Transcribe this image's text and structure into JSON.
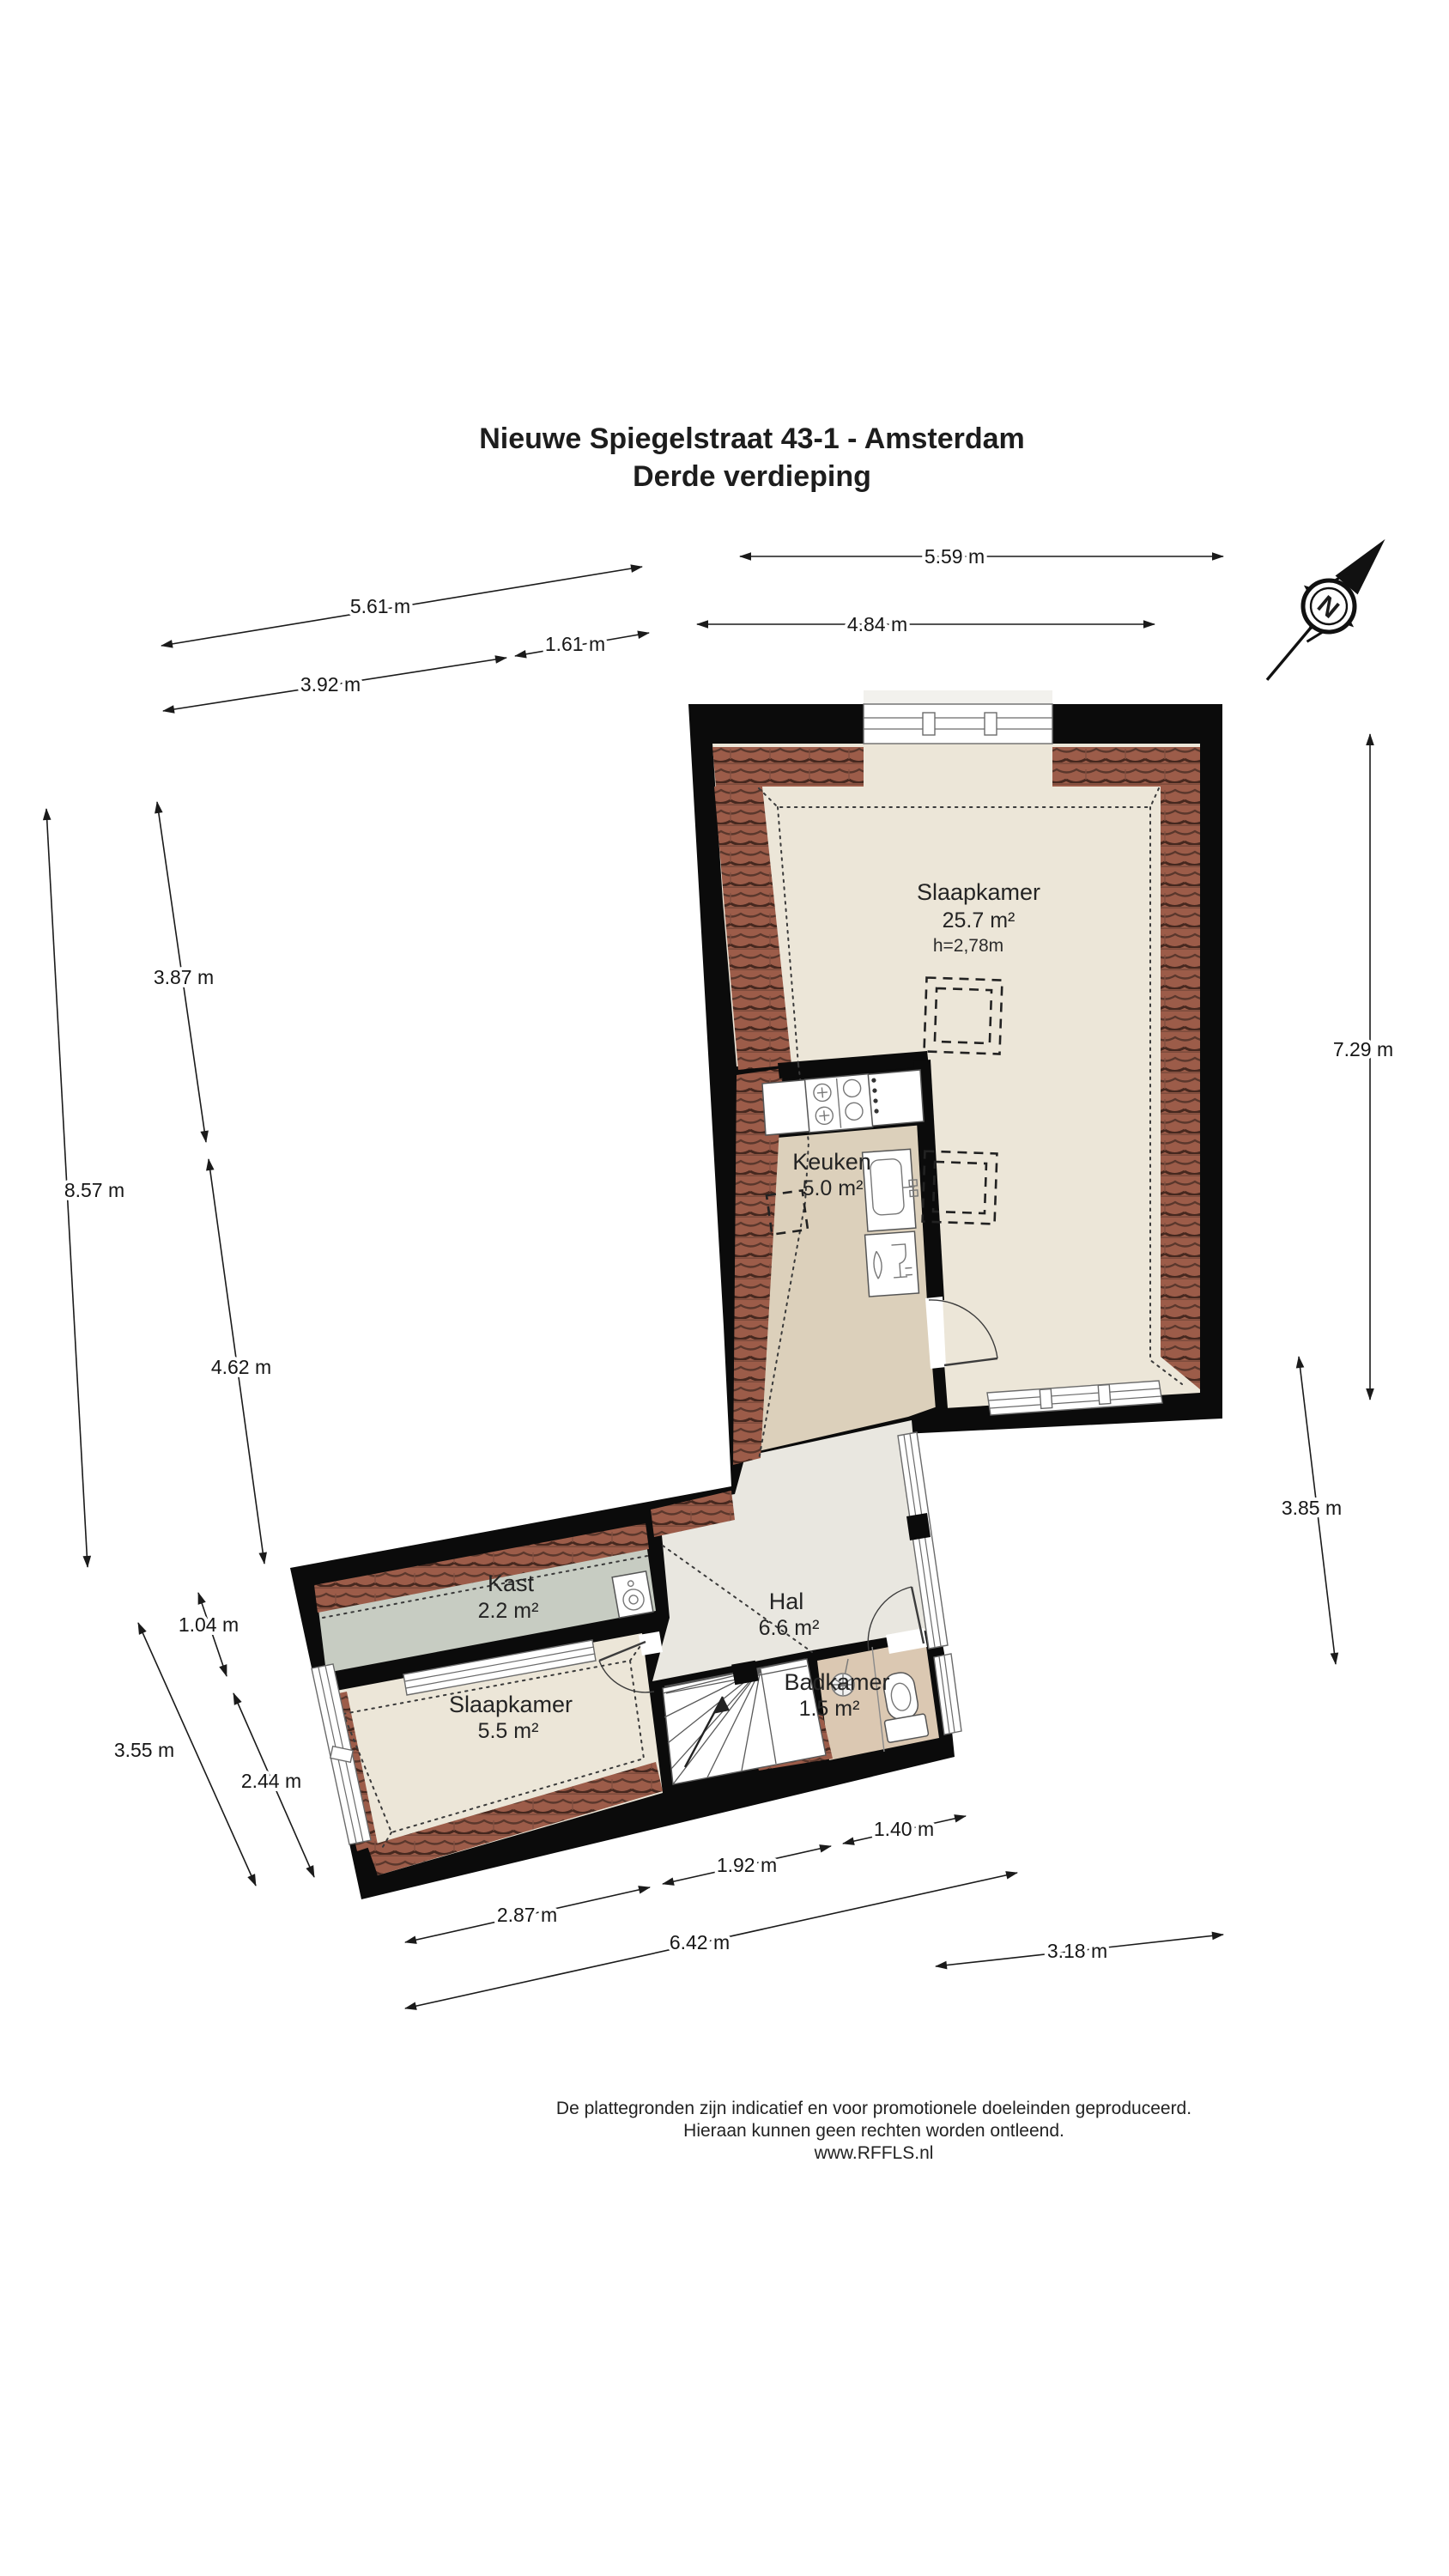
{
  "title": {
    "line1": "Nieuwe Spiegelstraat 43-1 - Amsterdam",
    "line2": "Derde verdieping"
  },
  "rooms": {
    "slaapkamer1": {
      "name": "Slaapkamer",
      "area": "25.7 m²",
      "ceiling": "h=2,78m"
    },
    "keuken": {
      "name": "Keuken",
      "area": "5.0 m²"
    },
    "kast": {
      "name": "Kast",
      "area": "2.2 m²"
    },
    "hal": {
      "name": "Hal",
      "area": "6.6 m²"
    },
    "slaapkamer2": {
      "name": "Slaapkamer",
      "area": "5.5 m²"
    },
    "badkamer": {
      "name": "Badkamer",
      "area": "1.5 m²"
    }
  },
  "dimensions": {
    "top_559": "5.59 m",
    "top_484": "4.84 m",
    "top_561": "5.61 m",
    "top_161": "1.61 m",
    "top_392": "3.92 m",
    "left_387": "3.87 m",
    "left_857": "8.57 m",
    "left_462": "4.62 m",
    "left_104": "1.04 m",
    "left_355": "3.55 m",
    "left_244": "2.44 m",
    "right_729": "7.29 m",
    "right_385": "3.85 m",
    "bottom_140": "1.40 m",
    "bottom_192": "1.92 m",
    "bottom_287": "2.87 m",
    "bottom_642": "6.42 m",
    "bottom_318": "3.18 m"
  },
  "compass": {
    "north_label": "N"
  },
  "footer": {
    "line1": "De plattegronden zijn indicatief en voor promotionele doeleinden geproduceerd.",
    "line2": "Hieraan kunnen geen rechten worden ontleend.",
    "line3": "www.RFFLS.nl"
  },
  "colors": {
    "wall": "#0b0b0b",
    "roof_tile": "#9c5c49",
    "floor_cream": "#ece6d8",
    "floor_kitchen": "#dcd0bb",
    "floor_hall": "#e9e7e0",
    "floor_closet": "#c7ccc2",
    "floor_bath": "#dbc8b2"
  }
}
